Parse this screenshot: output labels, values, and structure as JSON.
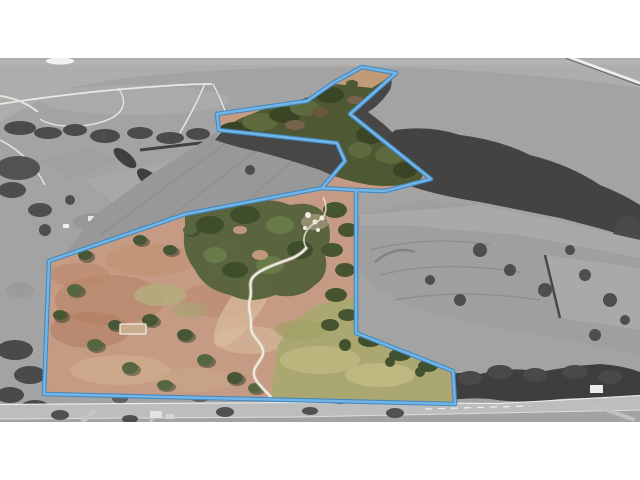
{
  "scene": {
    "type": "aerial-drone-photograph",
    "subject": "rural acreage property listing photo with highlighted parcel boundary",
    "style": "land inside the blue boundary shown in natural color; surrounding terrain desaturated to grayscale; white letterbox bars above and below the photo",
    "letterbox_color": "#ffffff"
  },
  "photo": {
    "left": 0,
    "top": 58,
    "width": 640,
    "height": 364
  },
  "palette": {
    "water": "#adadad",
    "water_streak": "#bababa",
    "land_gray": "#a3a3a3",
    "forest_gray": "#474747",
    "forest_gray_dark": "#3e3e3e",
    "field_gray": "#989898",
    "field_gray_east": "#9f9f9f",
    "field_gray_pale": "#a9a9a9",
    "road_gray": "#bdbdbd",
    "pasture_tan": "#c59b83",
    "pasture_rust": "#b2805f",
    "pasture_pale": "#d8bc9e",
    "field_green": "#aba771",
    "forest_green": "#4e5832",
    "tree_green": "#475634",
    "trail_white": "#ece9e3",
    "structure_white": "#f1ede3",
    "pier_white": "#ededed",
    "pier_shadow": "#6f6f6f"
  },
  "boundary": {
    "label": "parcel-outline",
    "points": "44,394 49,261 186,214 322,188 345,161 337,143 219,130 217,114 307,101 333,83 362,67 396,73 350,114 431,179 385,191 356,190 356,333 453,371 455,404",
    "spur_path": "M322,188 L356,190",
    "outer_color": "#4187c0",
    "inner_color": "#73b6e6"
  },
  "features": {
    "water": "lake along the top of the photo",
    "pier": "long jetty crossing the water at top right",
    "headland": "gray peninsula with white walking trails at top left",
    "excluded_field": "gray plowed field notched into the parcel",
    "east_field": "large gray cultivated field east of the parcel",
    "pasture": "salmon colored open pasture inside the parcel",
    "green_field": "yellow-green paddock in the southeast of the parcel",
    "woodland": "green tree cover through the center and north of the parcel",
    "driveway": "white winding driveway entering from the highway",
    "homestead": "small white structures near the center of the parcel",
    "corral": "white fenced yard in the western pasture",
    "highway": "gray road corridor running along the bottom of the photo"
  }
}
